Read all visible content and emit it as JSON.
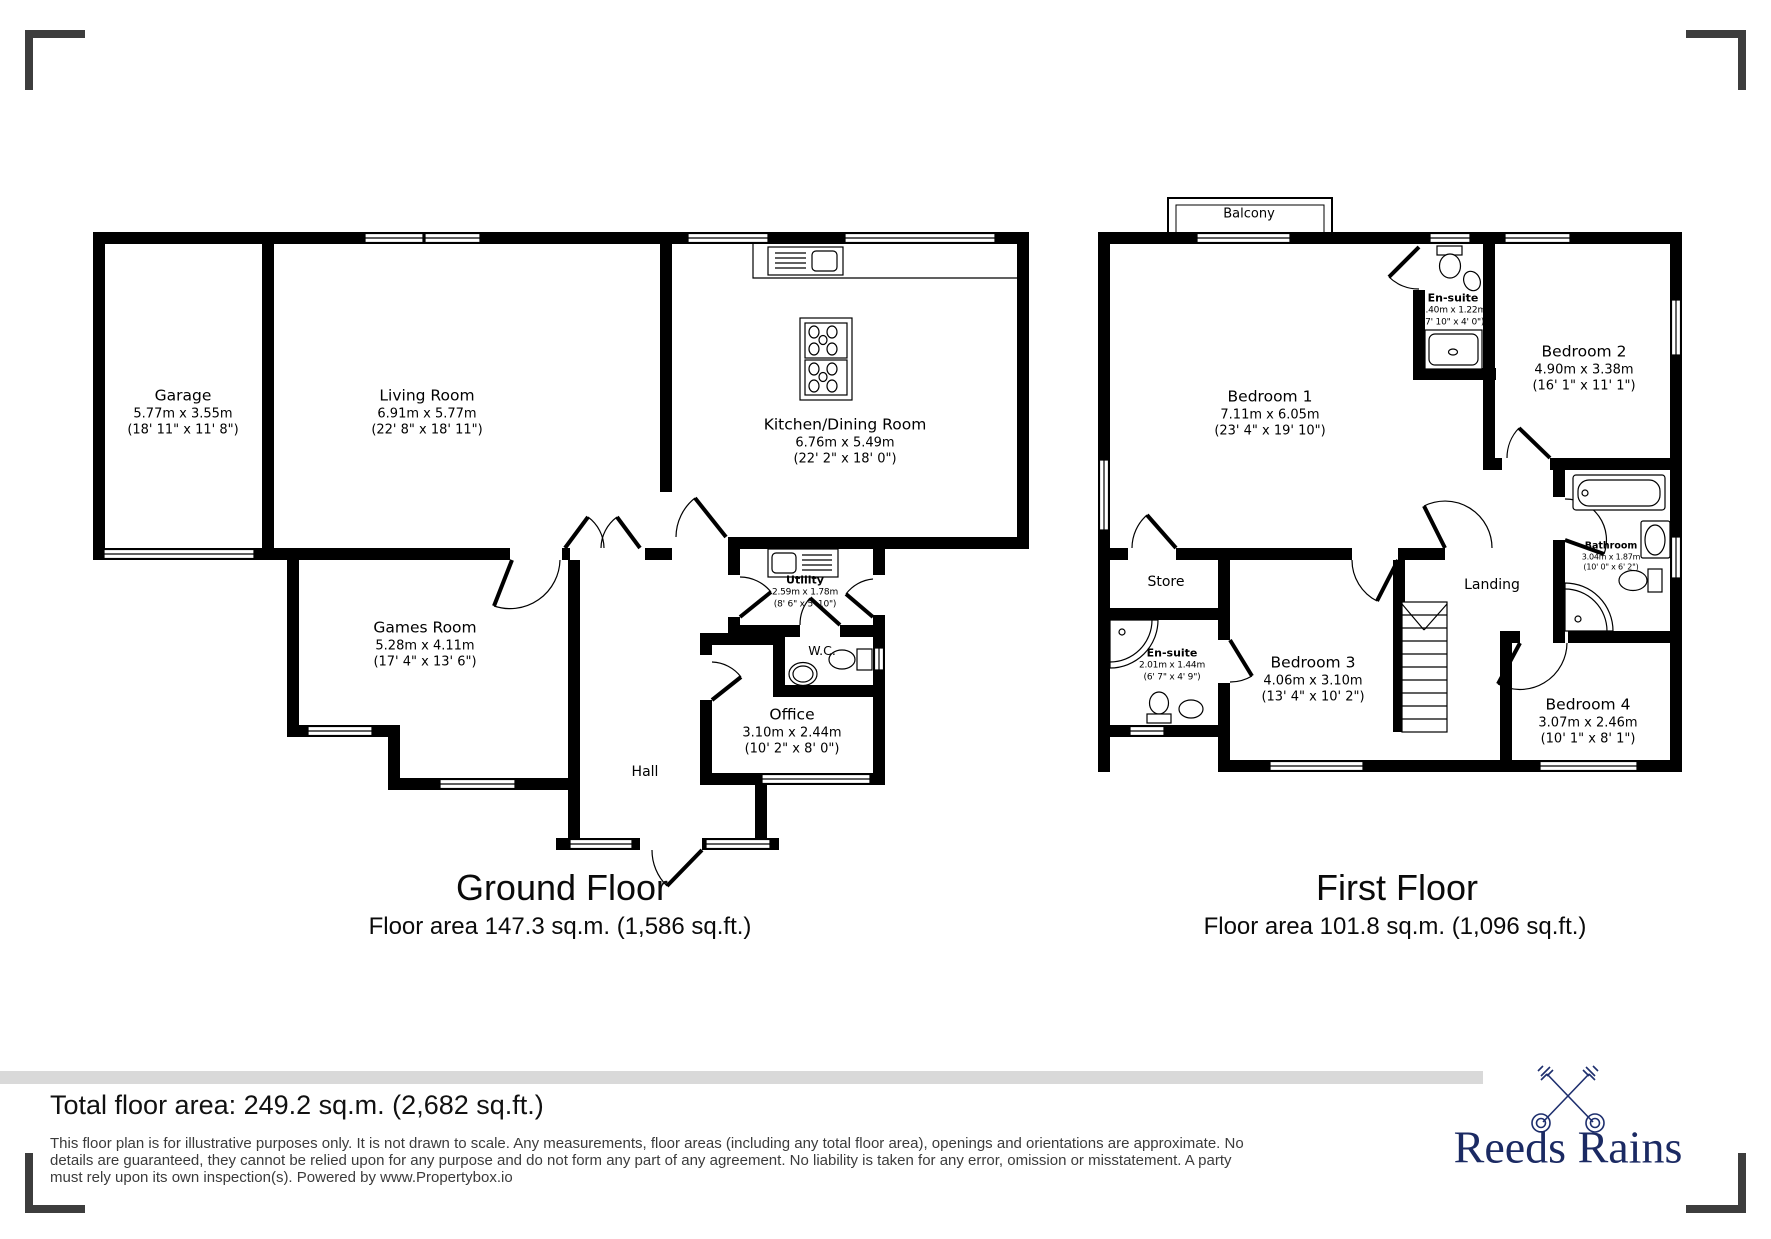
{
  "colors": {
    "wall": "#000000",
    "gray_band": "#d9d9d9",
    "corner_mark": "#3d3d3d",
    "brand_navy": "#1b2a63",
    "disclaimer_text": "#3b3b3b"
  },
  "ground_floor": {
    "title": "Ground Floor",
    "area": "Floor area 147.3 sq.m. (1,586 sq.ft.)",
    "rooms": {
      "garage": {
        "name": "Garage",
        "metric": "5.77m x 3.55m",
        "imperial": "(18' 11\" x 11' 8\")"
      },
      "living_room": {
        "name": "Living Room",
        "metric": "6.91m x 5.77m",
        "imperial": "(22' 8\" x 18' 11\")"
      },
      "kitchen": {
        "name": "Kitchen/Dining Room",
        "metric": "6.76m x 5.49m",
        "imperial": "(22' 2\" x 18' 0\")"
      },
      "games_room": {
        "name": "Games Room",
        "metric": "5.28m x 4.11m",
        "imperial": "(17' 4\" x 13' 6\")"
      },
      "utility": {
        "name": "Utility",
        "metric": "2.59m x 1.78m",
        "imperial": "(8' 6\" x 5' 10\")"
      },
      "wc": {
        "name": "W.C."
      },
      "office": {
        "name": "Office",
        "metric": "3.10m x 2.44m",
        "imperial": "(10' 2\" x 8' 0\")"
      },
      "hall": {
        "name": "Hall"
      }
    }
  },
  "first_floor": {
    "title": "First Floor",
    "area": "Floor area 101.8 sq.m. (1,096 sq.ft.)",
    "rooms": {
      "balcony": {
        "name": "Balcony"
      },
      "bedroom1": {
        "name": "Bedroom 1",
        "metric": "7.11m x 6.05m",
        "imperial": "(23' 4\" x 19' 10\")"
      },
      "ensuite1": {
        "name": "En-suite",
        "metric": "2.40m x 1.22m",
        "imperial": "(7' 10\" x 4' 0\")"
      },
      "bedroom2": {
        "name": "Bedroom 2",
        "metric": "4.90m x 3.38m",
        "imperial": "(16' 1\" x 11' 1\")"
      },
      "store": {
        "name": "Store"
      },
      "ensuite2": {
        "name": "En-suite",
        "metric": "2.01m x 1.44m",
        "imperial": "(6' 7\" x 4' 9\")"
      },
      "bedroom3": {
        "name": "Bedroom 3",
        "metric": "4.06m x 3.10m",
        "imperial": "(13' 4\" x 10' 2\")"
      },
      "landing": {
        "name": "Landing"
      },
      "bathroom": {
        "name": "Bathroom",
        "metric": "3.04m x 1.87m",
        "imperial": "(10' 0\" x 6' 2\")"
      },
      "bedroom4": {
        "name": "Bedroom 4",
        "metric": "3.07m x 2.46m",
        "imperial": "(10' 1\" x 8' 1\")"
      }
    }
  },
  "footer": {
    "total": "Total floor area: 249.2 sq.m. (2,682 sq.ft.)",
    "disclaimer": [
      "This floor plan is for illustrative purposes only. It is not drawn to scale. Any measurements, floor areas (including any total floor area), openings and orientations are approximate. No",
      "details are guaranteed, they cannot be relied upon for any purpose and do not form any part of any agreement. No liability is taken for any error, omission or misstatement. A party",
      "must rely upon its own inspection(s). Powered by www.Propertybox.io"
    ],
    "brand": "Reeds Rains"
  }
}
